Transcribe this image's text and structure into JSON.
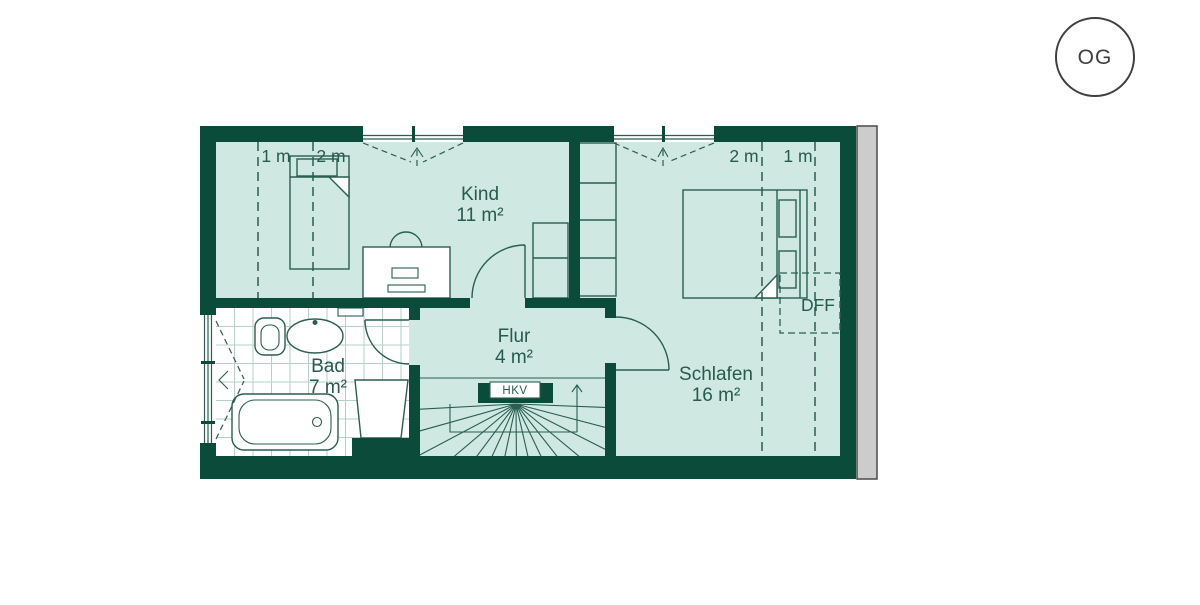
{
  "page": {
    "background": "#ffffff"
  },
  "floor_badge": {
    "label": "OG"
  },
  "rooms": {
    "kind": {
      "name": "Kind",
      "area": "11 m²"
    },
    "schlafen": {
      "name": "Schlafen",
      "area": "16 m²"
    },
    "bad": {
      "name": "Bad",
      "area": "7 m²"
    },
    "flur": {
      "name": "Flur",
      "area": "4 m²"
    }
  },
  "height_markers": {
    "left": {
      "m1": "1 m",
      "m2": "2 m"
    },
    "right": {
      "m2": "2 m",
      "m1": "1 m"
    }
  },
  "annotations": {
    "roof_window": "DFF",
    "heating_manifold": "HKV"
  },
  "colors": {
    "wall": "#0a4b3a",
    "floor": "#cfe8e2",
    "line": "#2a5e50",
    "text": "#275b4d",
    "tile": "#b6d0c9",
    "bath_floor": "#ffffff",
    "party_wall": "#cccccc",
    "party_wall_border": "#4a4a4a",
    "badge": "#3f3f3f",
    "background": "#ffffff"
  }
}
